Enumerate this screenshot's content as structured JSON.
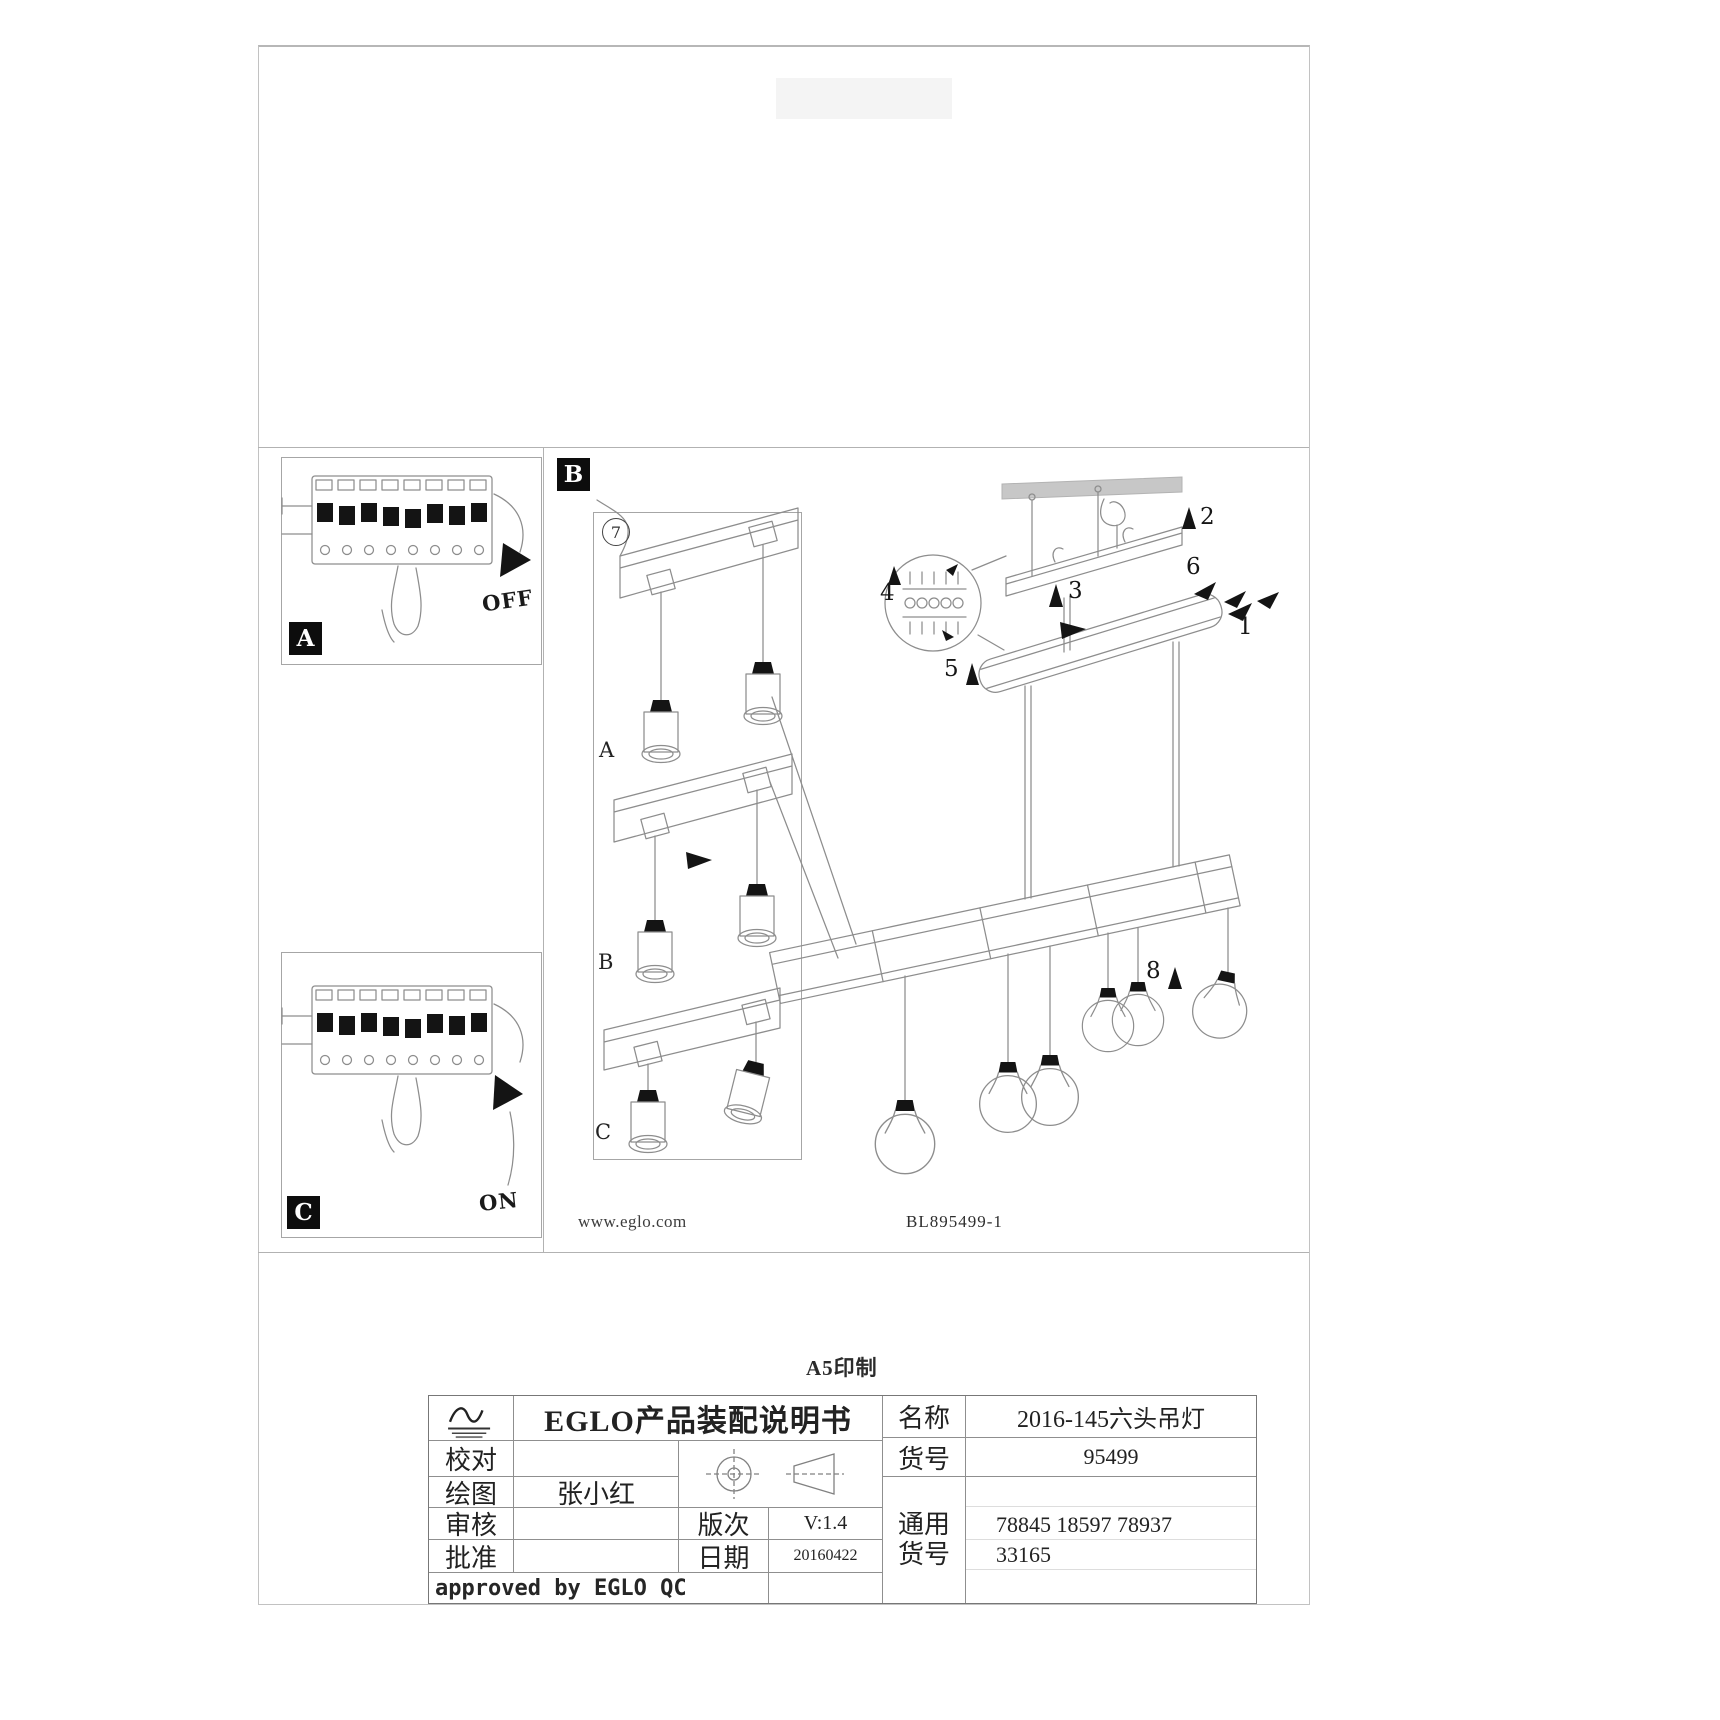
{
  "document": {
    "print_note": "A5印制",
    "website": "www.eglo.com",
    "drawing_no": "BL895499-1"
  },
  "sections": {
    "a_label": "A",
    "a_state": "OFF",
    "b_label": "B",
    "c_label": "C",
    "c_state": "ON",
    "step_7": "7",
    "sub_a": "A",
    "sub_b": "B",
    "sub_c": "C"
  },
  "callouts": {
    "n1": "1",
    "n2": "2",
    "n3": "3",
    "n4": "4",
    "n5": "5",
    "n6": "6",
    "n8": "8"
  },
  "title_block": {
    "header": "EGLO产品装配说明书",
    "proofread_label": "校对",
    "draft_label": "绘图",
    "draft_value": "张小红",
    "review_label": "审核",
    "approve_label": "批准",
    "version_label": "版次",
    "version_value": "V:1.4",
    "date_label": "日期",
    "date_value": "20160422",
    "approved_note": "approved by EGLO QC",
    "name_label": "名称",
    "name_value": "2016-145六头吊灯",
    "item_label": "货号",
    "item_value": "95499",
    "common_label_1": "通用",
    "common_label_2": "货号",
    "common_value_1": "78845 18597 78937",
    "common_value_2": "33165"
  },
  "colors": {
    "ink": "#1f1f1f",
    "line_gray": "#8d8d8d",
    "label_bg": "#0d0d0d",
    "ceiling_bar": "#c7c7c7"
  }
}
